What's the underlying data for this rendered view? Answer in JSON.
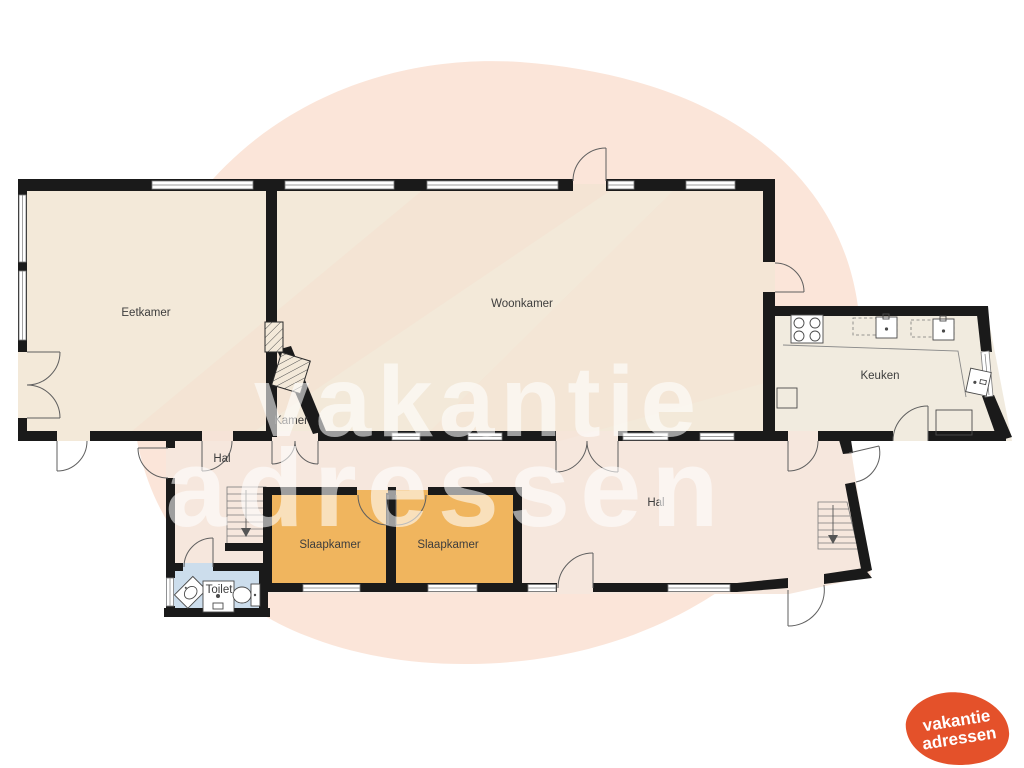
{
  "rooms": {
    "eetkamer": "Eetkamer",
    "woonkamer": "Woonkamer",
    "kamer": "Kamer",
    "keuken": "Keuken",
    "hal_left": "Hal",
    "hal_right": "Hal",
    "slaapkamer_1": "Slaapkamer",
    "slaapkamer_2": "Slaapkamer",
    "toilet": "Toilet"
  },
  "watermark": {
    "line1": "vakantie",
    "line2": "adressen"
  },
  "logo": {
    "line1": "vakantie",
    "line2": "adressen"
  },
  "colors": {
    "wall": "#1a1a1a",
    "floor_main": "#f3e9d9",
    "floor_kitchen": "#f1ebdf",
    "floor_hall": "#f6e7dd",
    "floor_bedroom": "#f0b55e",
    "floor_toilet": "#ccddec",
    "blob": "#fbe5d9",
    "logo_orange": "#e4512a",
    "label": "#3d3d3d",
    "watermark": "rgba(255,255,255,0.58)"
  }
}
